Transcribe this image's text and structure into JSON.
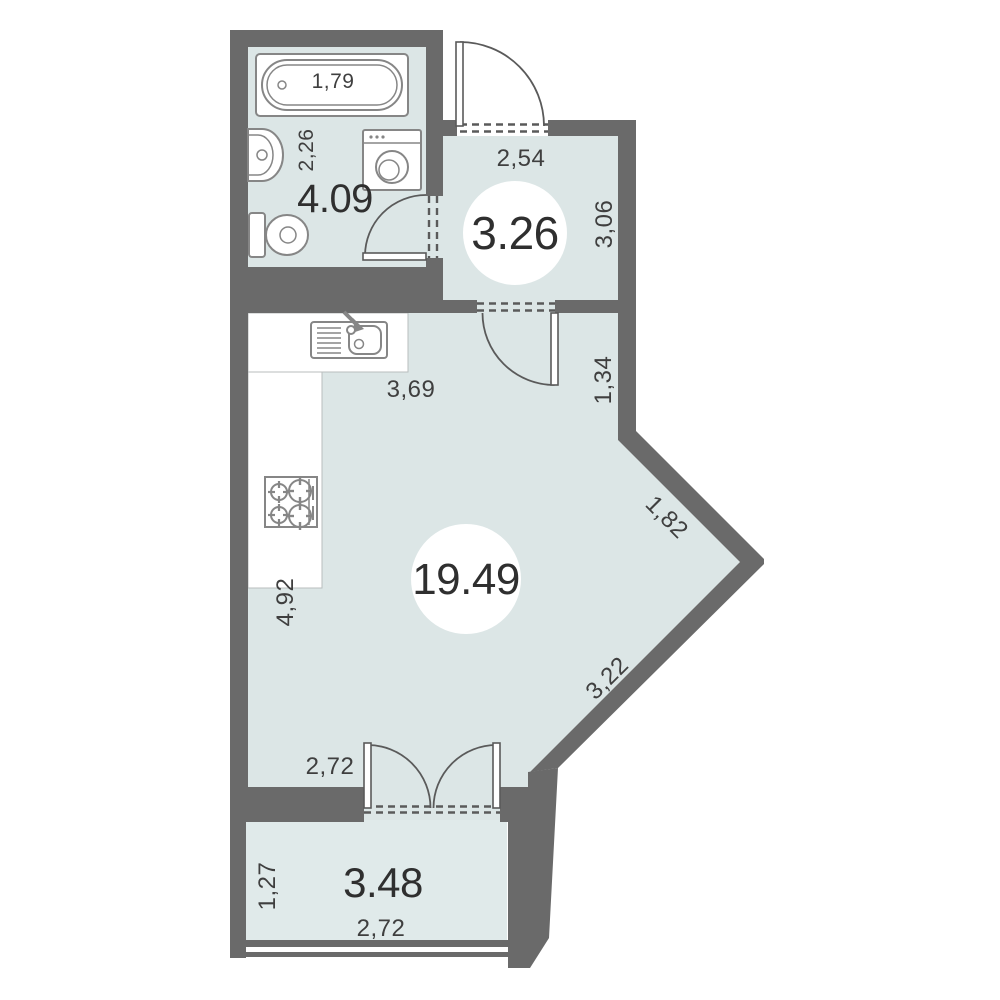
{
  "title": "Studio apartment floor plan",
  "colors": {
    "wall": "#6a6a6a",
    "room_fill": "#dce6e6",
    "balcony_fill": "#e0eaea",
    "fixture_stroke": "#868686",
    "door_line": "#5a5a5a",
    "text": "#3f3f3f",
    "area_text": "#2f2f2f",
    "background": "#ffffff"
  },
  "rooms": {
    "bathroom": {
      "area": "4.09",
      "width": "2,26",
      "tub_length": "1,79"
    },
    "hall": {
      "area": "3.26",
      "width": "2,54",
      "depth": "3,06",
      "passage": "1,34"
    },
    "living": {
      "area": "19.49",
      "kitchen_wall": "3,69",
      "left_wall": "4,92",
      "diagonal_upper": "1,82",
      "diagonal_lower": "3,22",
      "balcony_door": "2,72"
    },
    "balcony": {
      "area": "3.48",
      "depth": "1,27",
      "width": "2,72"
    }
  },
  "fixtures": [
    "bathtub",
    "washbasin",
    "toilet",
    "washing-machine",
    "kitchen-sink",
    "cooktop"
  ]
}
